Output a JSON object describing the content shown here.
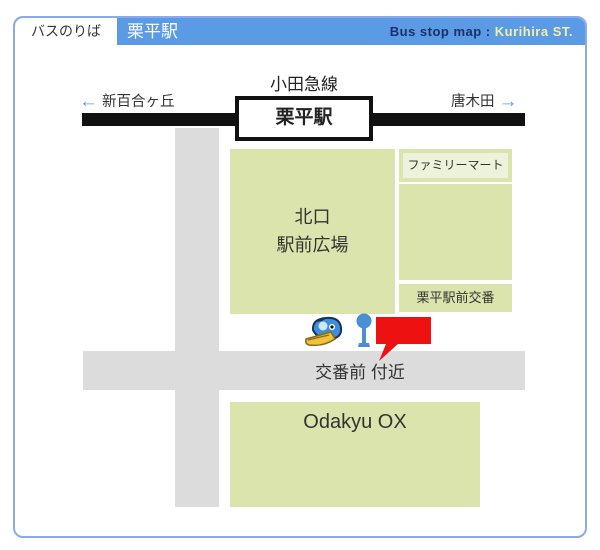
{
  "header": {
    "tab_label": "バスのりば",
    "station_title": "栗平駅",
    "subtitle_prefix": "Bus stop map : ",
    "subtitle_station": "Kurihira ST."
  },
  "railway": {
    "line_name": "小田急線",
    "station_box_label": "栗平駅",
    "left_arrow": "←",
    "left_destination": "新百合ヶ丘",
    "right_destination": "唐木田",
    "right_arrow": "→"
  },
  "map": {
    "plaza_label_line1": "北口",
    "plaza_label_line2": "駅前広場",
    "familymart_label": "ファミリーマート",
    "koban_label": "栗平駅前交番",
    "bus_stop_label": "交番前 付近",
    "store_label": "Odakyu OX"
  },
  "icons": {
    "bird_mascot": "bird-mascot-icon",
    "bus_stop_pole": "bus-stop-pole-icon",
    "location_flag": "red-flag-marker-icon"
  },
  "colors": {
    "header_blue": "#5b9ae4",
    "panel_border_blue": "#8aabe8",
    "subtitle_navy": "#1c2f66",
    "subtitle_yellow": "#f2f0a0",
    "block_green": "#dbe4ad",
    "familymart_inner_green": "#edf3da",
    "road_gray": "#dcdcdc",
    "railway_black": "#111111",
    "flag_red": "#ee1111",
    "arrow_blue": "#6699eb",
    "pole_blue": "#4a8fd4"
  }
}
